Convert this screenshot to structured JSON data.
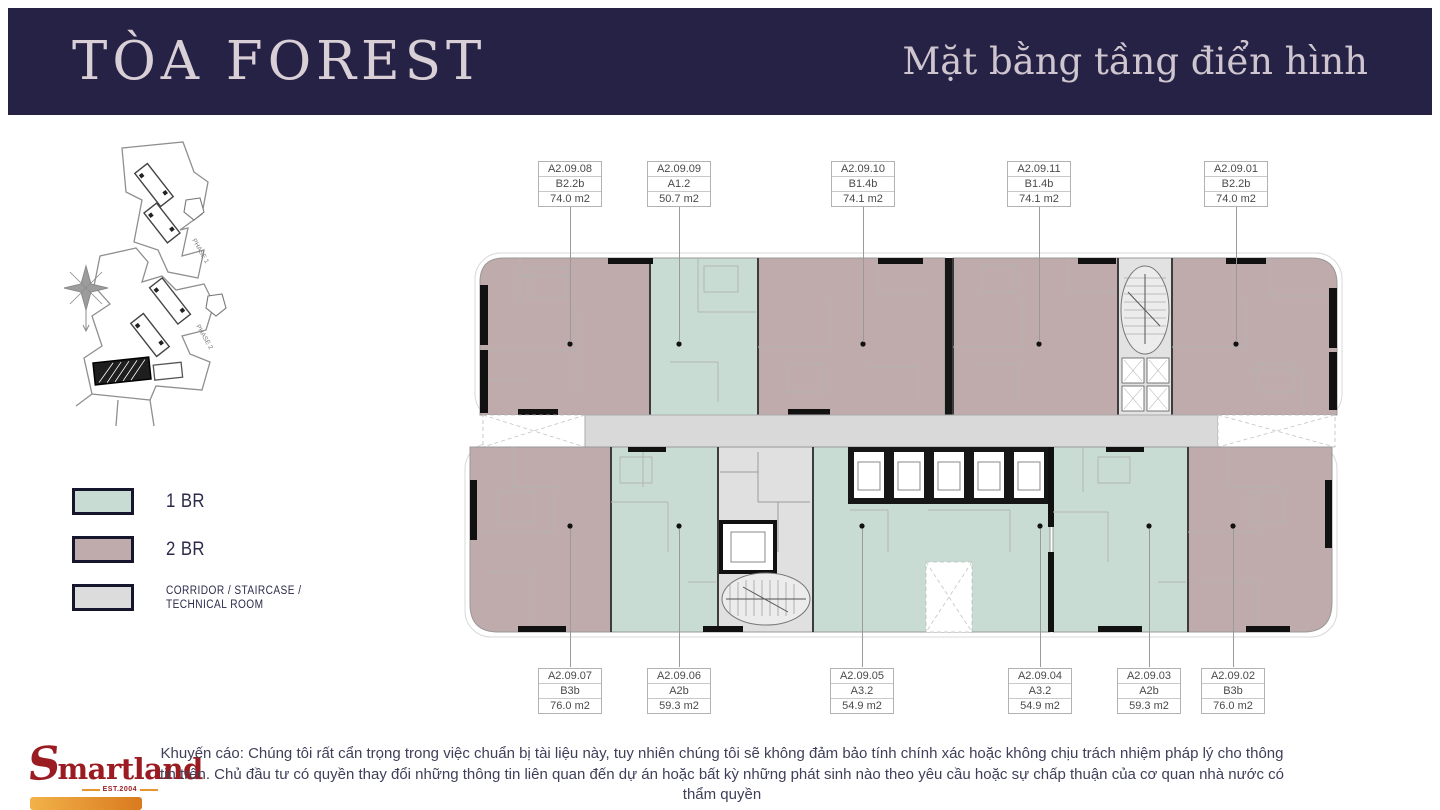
{
  "header": {
    "title": "TÒA FOREST",
    "subtitle": "Mặt bằng tầng điển hình"
  },
  "legend": {
    "items": [
      {
        "label": "1 BR",
        "color": "#c8dcd4"
      },
      {
        "label": "2 BR",
        "color": "#bfabab"
      },
      {
        "label": "CORRIDOR / STAIRCASE / TECHNICAL ROOM",
        "color": "#dcdcdc"
      }
    ]
  },
  "site_map": {
    "phase1_label": "PHASE 1",
    "phase2_label": "PHASE 2"
  },
  "plan": {
    "labels": [
      {
        "id": "A2.09.08",
        "type": "B2.2b",
        "area": "74.0 m2"
      },
      {
        "id": "A2.09.09",
        "type": "A1.2",
        "area": "50.7 m2"
      },
      {
        "id": "A2.09.10",
        "type": "B1.4b",
        "area": "74.1 m2"
      },
      {
        "id": "A2.09.11",
        "type": "B1.4b",
        "area": "74.1 m2"
      },
      {
        "id": "A2.09.01",
        "type": "B2.2b",
        "area": "74.0 m2"
      },
      {
        "id": "A2.09.07",
        "type": "B3b",
        "area": "76.0 m2"
      },
      {
        "id": "A2.09.06",
        "type": "A2b",
        "area": "59.3 m2"
      },
      {
        "id": "A2.09.05",
        "type": "A3.2",
        "area": "54.9 m2"
      },
      {
        "id": "A2.09.04",
        "type": "A3.2",
        "area": "54.9 m2"
      },
      {
        "id": "A2.09.03",
        "type": "A2b",
        "area": "59.3 m2"
      },
      {
        "id": "A2.09.02",
        "type": "B3b",
        "area": "76.0 m2"
      }
    ]
  },
  "footer": {
    "logo_s": "S",
    "logo_rest": "martland",
    "est": "EST.2004",
    "disclaimer": "Khuyến cáo: Chúng tôi rất cẩn trọng trong việc chuẩn bị tài liệu này, tuy nhiên chúng tôi sẽ không đảm bảo tính chính xác hoặc không chịu trách nhiệm pháp lý cho thông tin trên. Chủ đầu tư có quyền thay đổi những thông tin liên quan đến dự án hoặc bất kỳ những phát sinh nào theo yêu cầu hoặc sự chấp thuận của cơ quan nhà nước có thẩm quyền"
  },
  "colors": {
    "header_bg": "#262245",
    "header_text": "#d9cfd7",
    "one_br": "#c8dcd4",
    "two_br": "#bfabab",
    "corridor": "#d9d9d9",
    "brand_red": "#9a1c22",
    "brand_orange": "#e8952e"
  }
}
